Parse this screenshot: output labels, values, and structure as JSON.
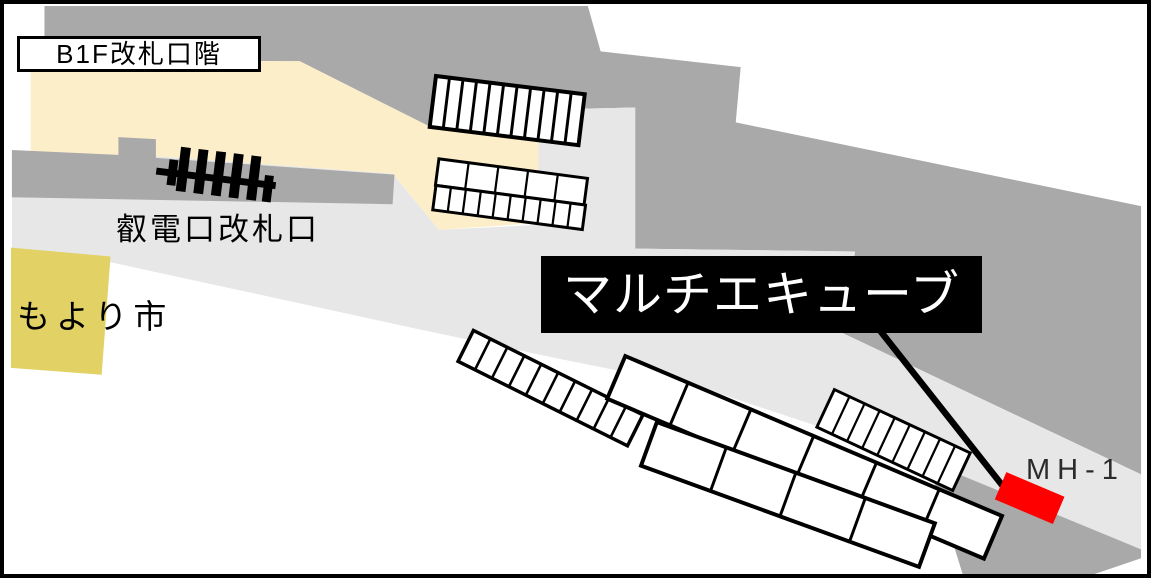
{
  "title": "B1F改札口階",
  "labels": {
    "floor": "B1F改札口階",
    "gate": "叡電口改札口",
    "market": "もより市",
    "cube": "マルチエキューブ",
    "locker_id": "MH-1"
  },
  "colors": {
    "dark_gray": "#a9a9a9",
    "light_gray": "#e7e7e7",
    "cream": "#fdeeca",
    "yellow": "#e2d164",
    "marker_red": "#ff0000",
    "callout_bg": "#000000",
    "callout_text": "#ffffff"
  },
  "map": {
    "regions": [
      {
        "name": "region-upper-concourse-gray",
        "fill": "#a9a9a9",
        "points": "37,2 588,2 601,48 743,64 738,120 1149,205 1149,477 847,334 859,251 636,248 636,105 546,107 538,137 427,124 296,58 37,58"
      },
      {
        "name": "region-main-floor-lightgray",
        "fill": "#e7e7e7",
        "points": "4,149 160,155 390,172 437,229 538,224 538,137 546,107 636,105 636,248 859,251 847,334 1149,477 1149,554 935,466 700,388 560,360 413,329 100,261 4,249"
      },
      {
        "name": "region-paid-area-cream",
        "fill": "#fdeeca",
        "points": "23,56 296,58 427,124 538,137 538,222 437,229 390,172 160,155 23,150"
      },
      {
        "name": "region-left-wall-gray",
        "fill": "#a9a9a9",
        "points": "4,148 112,153 112,135 150,137 150,156 392,173 390,203 4,196"
      },
      {
        "name": "region-bottom-corner-gray",
        "fill": "#a9a9a9",
        "points": "933,464 1149,553 1149,562 1102,578 968,578"
      },
      {
        "name": "region-market-area-yellow",
        "fill": "#e2d164",
        "points": "3,247 104,256 95,376 3,369"
      }
    ],
    "locker_strips": [
      {
        "name": "locker-strip-a",
        "x": 434,
        "y": 73,
        "len": 152,
        "wid": 52,
        "rot": 7,
        "cells": 11,
        "stroke": 4
      },
      {
        "name": "locker-strip-b-top",
        "x": 437,
        "y": 157,
        "len": 152,
        "wid": 27,
        "rot": 7.5,
        "cells": 5,
        "stroke": 3
      },
      {
        "name": "locker-strip-b-bottom",
        "x": 434,
        "y": 184,
        "len": 153,
        "wid": 25,
        "rot": 7.5,
        "cells": 10,
        "stroke": 3
      },
      {
        "name": "locker-strip-c",
        "x": 472,
        "y": 331,
        "len": 192,
        "wid": 35,
        "rot": 26.5,
        "cells": 10,
        "stroke": 3.5
      },
      {
        "name": "shop-strip-d",
        "x": 626,
        "y": 357,
        "len": 415,
        "wid": 47,
        "rot": 23,
        "cells": 6,
        "stroke": 4
      },
      {
        "name": "shop-strip-e",
        "x": 658,
        "y": 424,
        "len": 300,
        "wid": 47,
        "rot": 20,
        "cells": 4,
        "stroke": 4
      },
      {
        "name": "locker-strip-f",
        "x": 838,
        "y": 391,
        "len": 152,
        "wid": 42,
        "rot": 25,
        "cells": 9,
        "stroke": 3
      }
    ],
    "gate_icon": {
      "x": 152,
      "y": 156,
      "rot": 7,
      "crossbar": [
        0,
        10,
        122,
        7
      ],
      "bars": [
        [
          12,
          0,
          9,
          26
        ],
        [
          22,
          -14,
          10,
          45
        ],
        [
          40,
          -14,
          10,
          45
        ],
        [
          58,
          -14,
          10,
          45
        ],
        [
          76,
          -14,
          10,
          45
        ],
        [
          94,
          -14,
          10,
          45
        ],
        [
          110,
          4,
          9,
          27
        ]
      ]
    },
    "leader_line": {
      "x1": 881,
      "y1": 327,
      "x2": 1009,
      "y2": 489,
      "width": 6.5
    },
    "marker": {
      "cx": 1036,
      "cy": 501,
      "w": 64,
      "h": 30,
      "rot": 23,
      "color": "#ff0000"
    }
  }
}
